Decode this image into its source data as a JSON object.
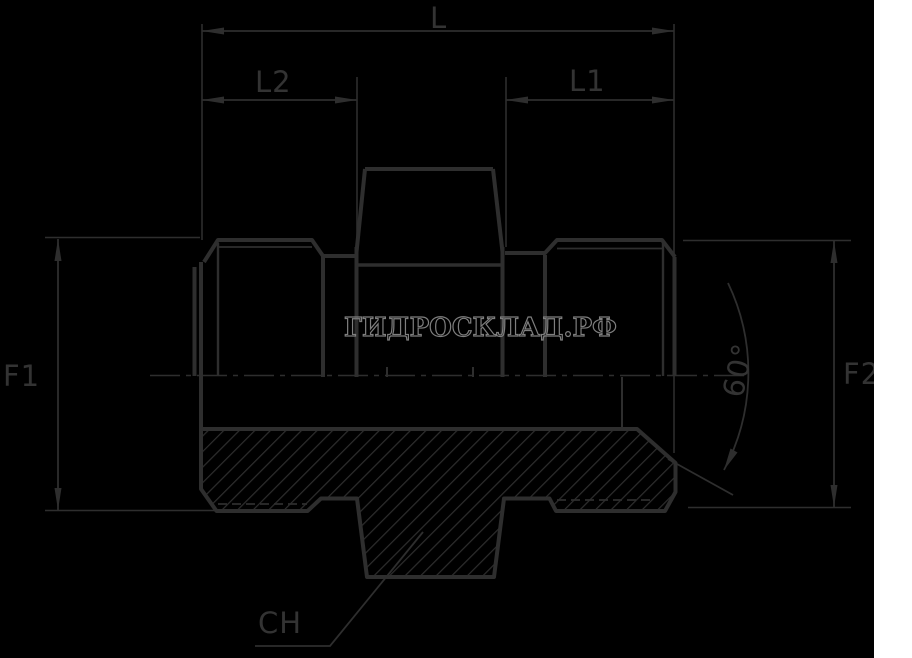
{
  "drawing": {
    "title": "male-male hydraulic adapter technical drawing",
    "watermark": "ГИДРОСКЛАД.РФ",
    "dimensions": {
      "overall_length": "L",
      "right_thread_length": "L1",
      "left_thread_length": "L2",
      "left_thread_size": "F1",
      "right_thread_size": "F2",
      "cone_angle": "60°",
      "hex_wrench_size": "CH"
    },
    "colors": {
      "background": "#000000",
      "line": "#2e2e2e",
      "label": "#333333",
      "watermark_outline": "#7e7e7e",
      "right_margin": "#ffffff"
    }
  }
}
